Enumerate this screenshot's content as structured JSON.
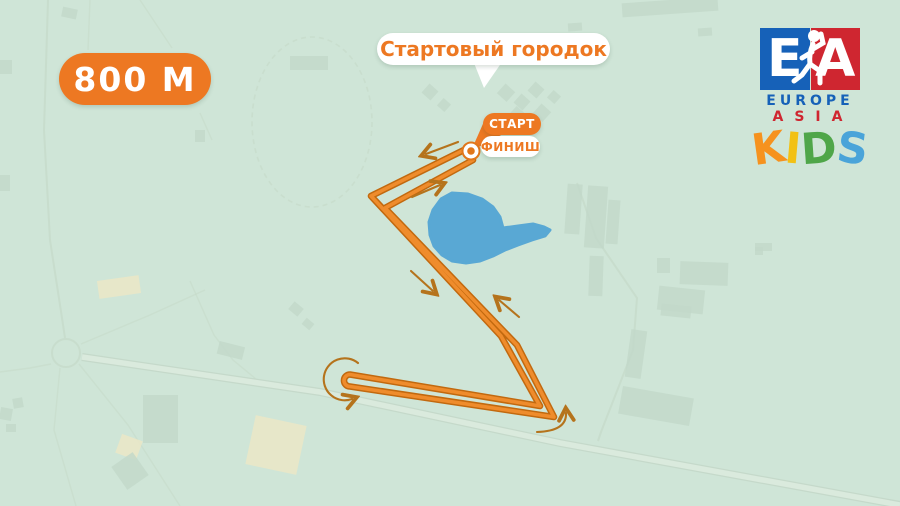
{
  "map": {
    "distance_badge_label": "800 M",
    "callout_label": "Стартовый городок",
    "start_label": "СТАРТ",
    "finish_label": "ФИНИШ"
  },
  "logo": {
    "monogram_left_letter": "E",
    "monogram_right_letter": "A",
    "word_top": "EUROPE",
    "word_bottom": "ASIA",
    "kids_word": [
      {
        "letter": "K",
        "color": "#f6921e",
        "tilt": -8
      },
      {
        "letter": "I",
        "color": "#f2c114",
        "tilt": 5
      },
      {
        "letter": "D",
        "color": "#4fa649",
        "tilt": -4
      },
      {
        "letter": "S",
        "color": "#4aa4d9",
        "tilt": 7
      }
    ]
  },
  "colors": {
    "background": "#cfe5d7",
    "route_orange": "#ef8c2c",
    "route_edge": "#c2690f",
    "accent_orange": "#ed7822",
    "arrow_brown": "#b5731c",
    "pond_blue": "#59a8d4",
    "logo_blue": "#1661b8",
    "logo_red": "#cf2630"
  }
}
